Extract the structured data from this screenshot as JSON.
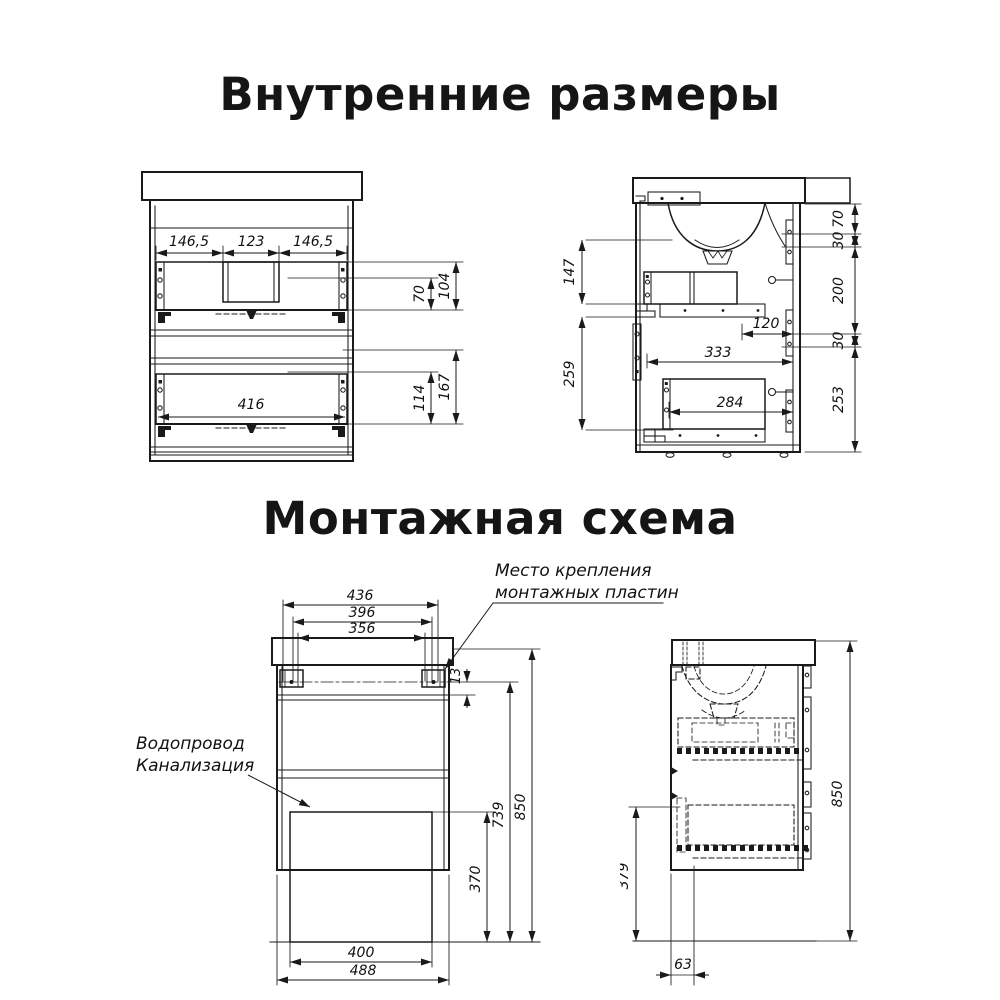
{
  "page": {
    "background": "#ffffff",
    "line_color": "#1a1a1a"
  },
  "sections": {
    "internal_title": "Внутренние размеры",
    "mounting_title": "Монтажная схема"
  },
  "front_view": {
    "dims": {
      "w_left": "146,5",
      "w_center": "123",
      "w_right": "146,5",
      "h_drawer1_front": "70",
      "h_drawer1_total": "104",
      "w_drawer2": "416",
      "h_drawer2_front": "114",
      "h_drawer2_total": "167"
    }
  },
  "side_view": {
    "dims": {
      "h_top": "147",
      "h_bottom": "259",
      "chain": [
        "70",
        "30",
        "200",
        "30",
        "253"
      ],
      "depth_small": "120",
      "depth_drawer1": "333",
      "depth_drawer2": "284"
    }
  },
  "mounting_front": {
    "dims": {
      "w_outer": "436",
      "w_mid": "396",
      "w_inner": "356",
      "plate_offset": "13",
      "h_hatch": "370",
      "h_plate_line": "739",
      "h_total": "850",
      "w_hatch": "400",
      "w_cabinet": "488"
    },
    "labels": {
      "plumbing_line1": "Водопровод",
      "plumbing_line2": "Канализация",
      "plates_line1": "Место крепления",
      "plates_line2": "монтажных пластин"
    }
  },
  "mounting_side": {
    "dims": {
      "h_total": "850",
      "h_plinth": "379",
      "d_back": "63"
    }
  }
}
